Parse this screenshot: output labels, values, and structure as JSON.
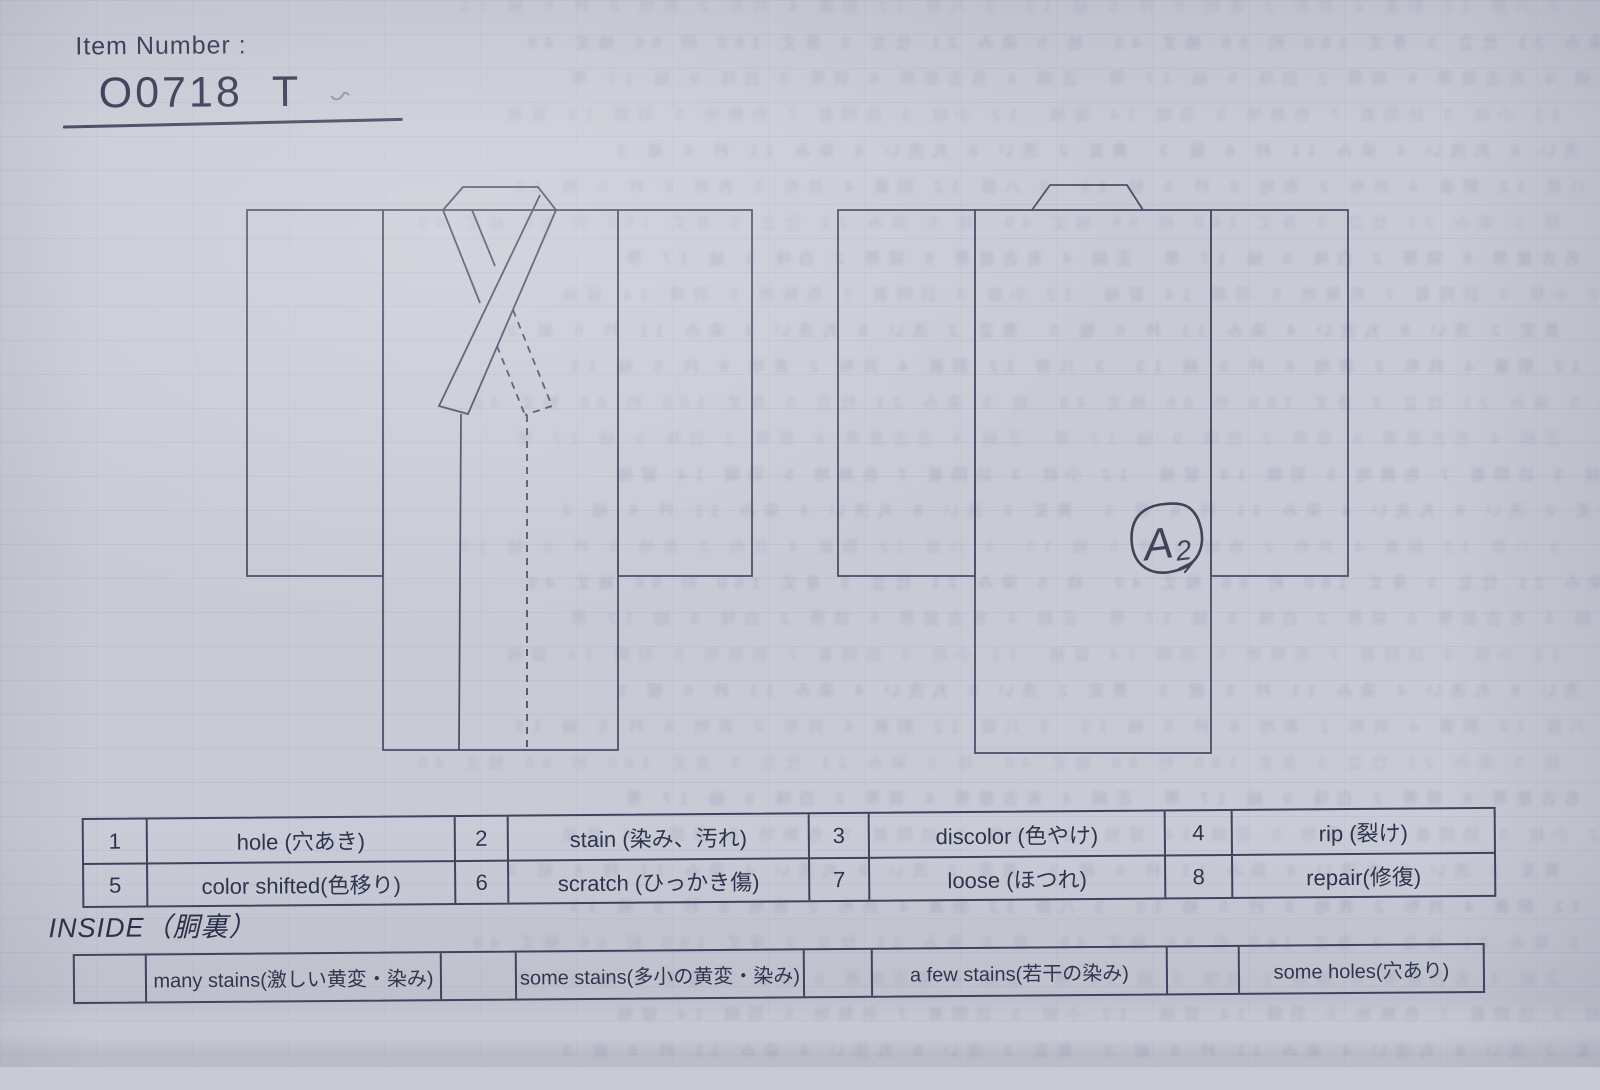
{
  "header": {
    "item_number_label": "Item Number :",
    "item_number_value": "O0718  T"
  },
  "diagram": {
    "annotation_letter": "A",
    "annotation_digit": "2"
  },
  "legend": {
    "items": [
      {
        "code": "1",
        "label": "hole (穴あき)"
      },
      {
        "code": "2",
        "label": "stain (染み、汚れ)"
      },
      {
        "code": "3",
        "label": "discolor (色やけ)"
      },
      {
        "code": "4",
        "label": "rip (裂け)"
      },
      {
        "code": "5",
        "label": "color shifted(色移り)"
      },
      {
        "code": "6",
        "label": "scratch (ひっかき傷)"
      },
      {
        "code": "7",
        "label": "loose (ほつれ)"
      },
      {
        "code": "8",
        "label": "repair(修復)"
      }
    ]
  },
  "inside": {
    "heading": "INSIDE（胴裏）",
    "options": [
      {
        "label": "many stains(激しい黄変・染み)"
      },
      {
        "label": "some stains(多小の黄変・染み)"
      },
      {
        "label": "a few stains(若干の染み)"
      },
      {
        "label": "some holes(穴あり)"
      }
    ]
  },
  "colors": {
    "paper": "#c8cad5",
    "table_line": "#3e445e",
    "drawing_line": "#4b5069",
    "ink_handwriting": "#3f4458",
    "text": "#2e344e"
  },
  "ghost": {
    "row_count": 30,
    "fragments": [
      "3 八掛 12 胴裏 4 共布 2 表地 8 衿 5 袖 13",
      "袷 5 染み 21 仕立 3 身丈 160 裄 66 袖丈 49",
      "正絹 4 名古屋帯 6 袋帯 2 白味 9 紬 17 帯",
      "12 小紋 3 訪問着 7 色無地 5 羽織 14 留袖",
      "黄変 2 洗い 8 丸洗い 4 染み 11 衿 6 裾 3"
    ]
  }
}
